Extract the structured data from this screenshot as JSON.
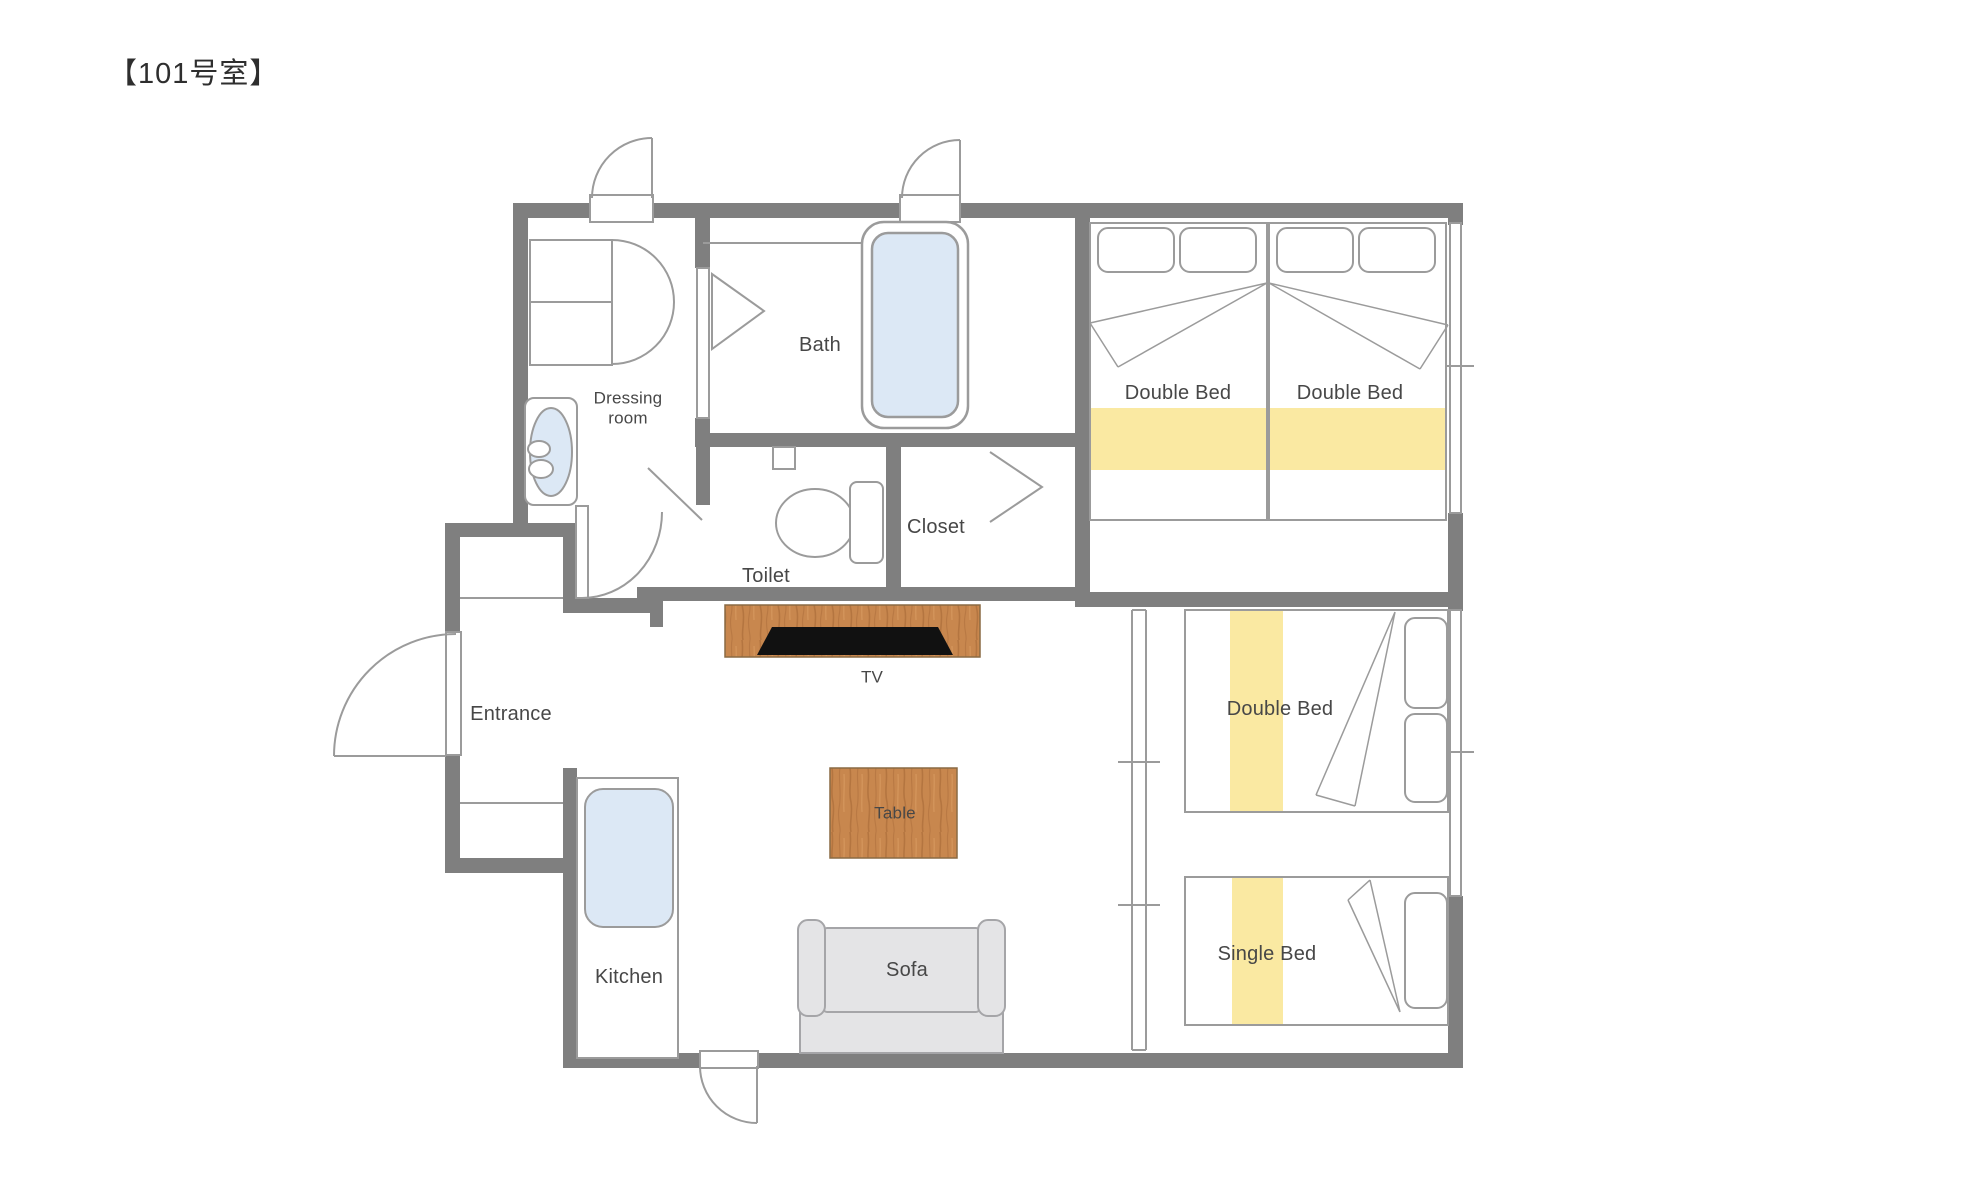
{
  "title": "【101号室】",
  "colors": {
    "wall": "#7f7f7f",
    "thin_line": "#9b9b9b",
    "fixture_blue": "#dce8f5",
    "bed_yellow": "#fae9a2",
    "wood": "#c8874e",
    "wood_streak": "#a96b39",
    "tv_black": "#111111",
    "sofa_gray": "#e4e4e6",
    "sofa_border": "#a5a5a8",
    "label_text": "#474747"
  },
  "rooms": {
    "dressing_room": {
      "label_line1": "Dressing",
      "label_line2": "room"
    },
    "bath": {
      "label": "Bath"
    },
    "toilet": {
      "label": "Toilet"
    },
    "closet": {
      "label": "Closet"
    },
    "entrance": {
      "label": "Entrance"
    },
    "kitchen": {
      "label": "Kitchen"
    }
  },
  "furniture": {
    "tv": {
      "label": "TV"
    },
    "table": {
      "label": "Table"
    },
    "sofa": {
      "label": "Sofa"
    }
  },
  "beds": {
    "double_bed_1": {
      "label": "Double Bed"
    },
    "double_bed_2": {
      "label": "Double Bed"
    },
    "double_bed_3": {
      "label": "Double Bed"
    },
    "single_bed": {
      "label": "Single Bed"
    }
  }
}
